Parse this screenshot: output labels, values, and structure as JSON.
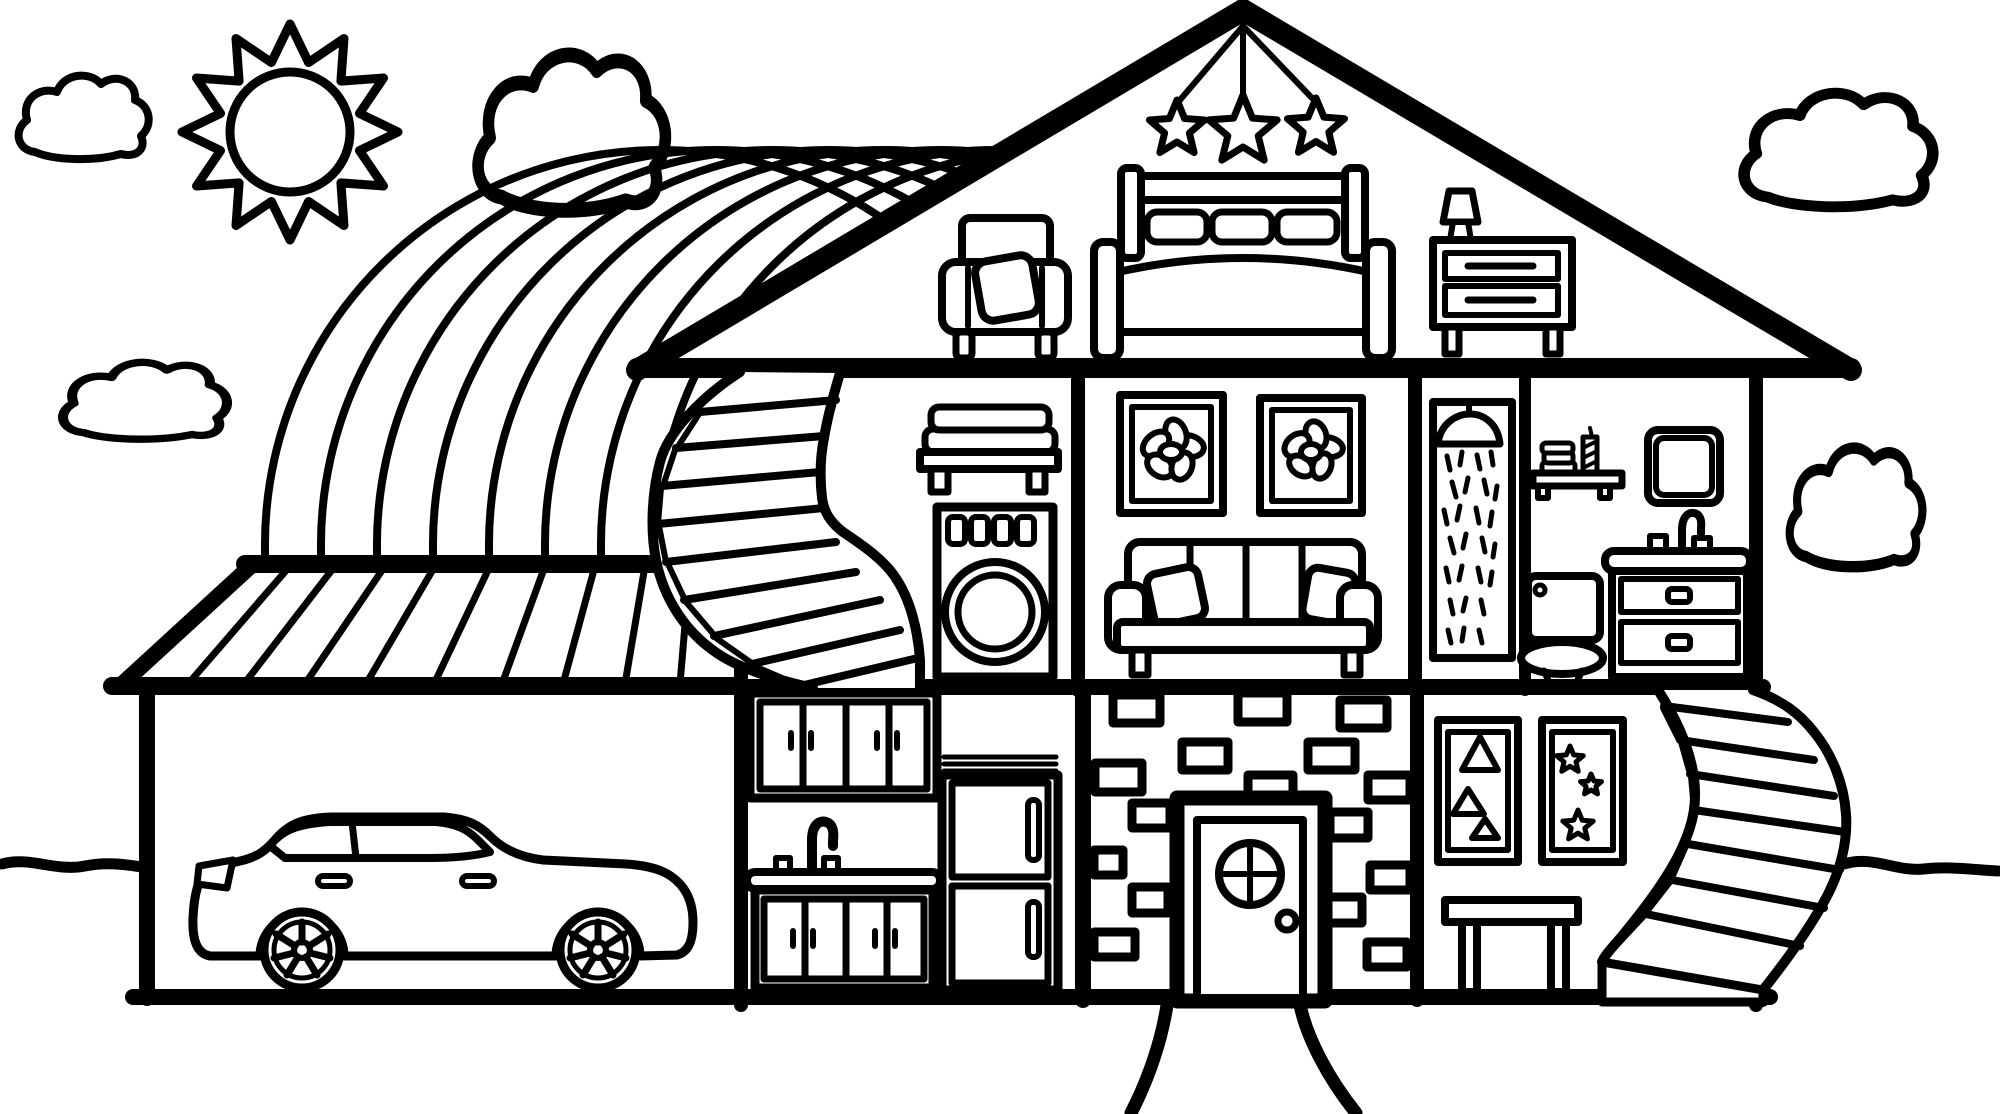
{
  "meta": {
    "kind": "coloring-page-illustration",
    "subject": "dollhouse cross-section with sun, clouds and rainbow",
    "palette": {
      "line": "#000000",
      "background": "#ffffff"
    }
  },
  "scene": {
    "sky": {
      "sun_count": 1,
      "cloud_count": 5,
      "rainbow_arc_count": 8
    },
    "attic": {
      "hanging_star_count": 3,
      "objects": [
        "armchair with pillow",
        "double bed with three pillows",
        "nightstand with lamp"
      ]
    },
    "middle_floor": {
      "objects": [
        "spiral staircase",
        "shelf with towels",
        "washing machine",
        "flower picture left",
        "flower picture right",
        "sofa with two pillows",
        "shower cabin",
        "bath shelf with towels and candle",
        "mirror cabinet",
        "sink vanity with two drawers",
        "toilet"
      ]
    },
    "ground_floor": {
      "objects": [
        "garage with car",
        "upper kitchen cabinets",
        "kitchen sink with counter",
        "lower kitchen cabinets",
        "refrigerator",
        "brick entry wall",
        "front door with porthole window",
        "triangle picture",
        "star picture",
        "side table",
        "outdoor curved staircase",
        "front path"
      ],
      "brick_count": 16,
      "wall_picture_count": 4
    }
  }
}
